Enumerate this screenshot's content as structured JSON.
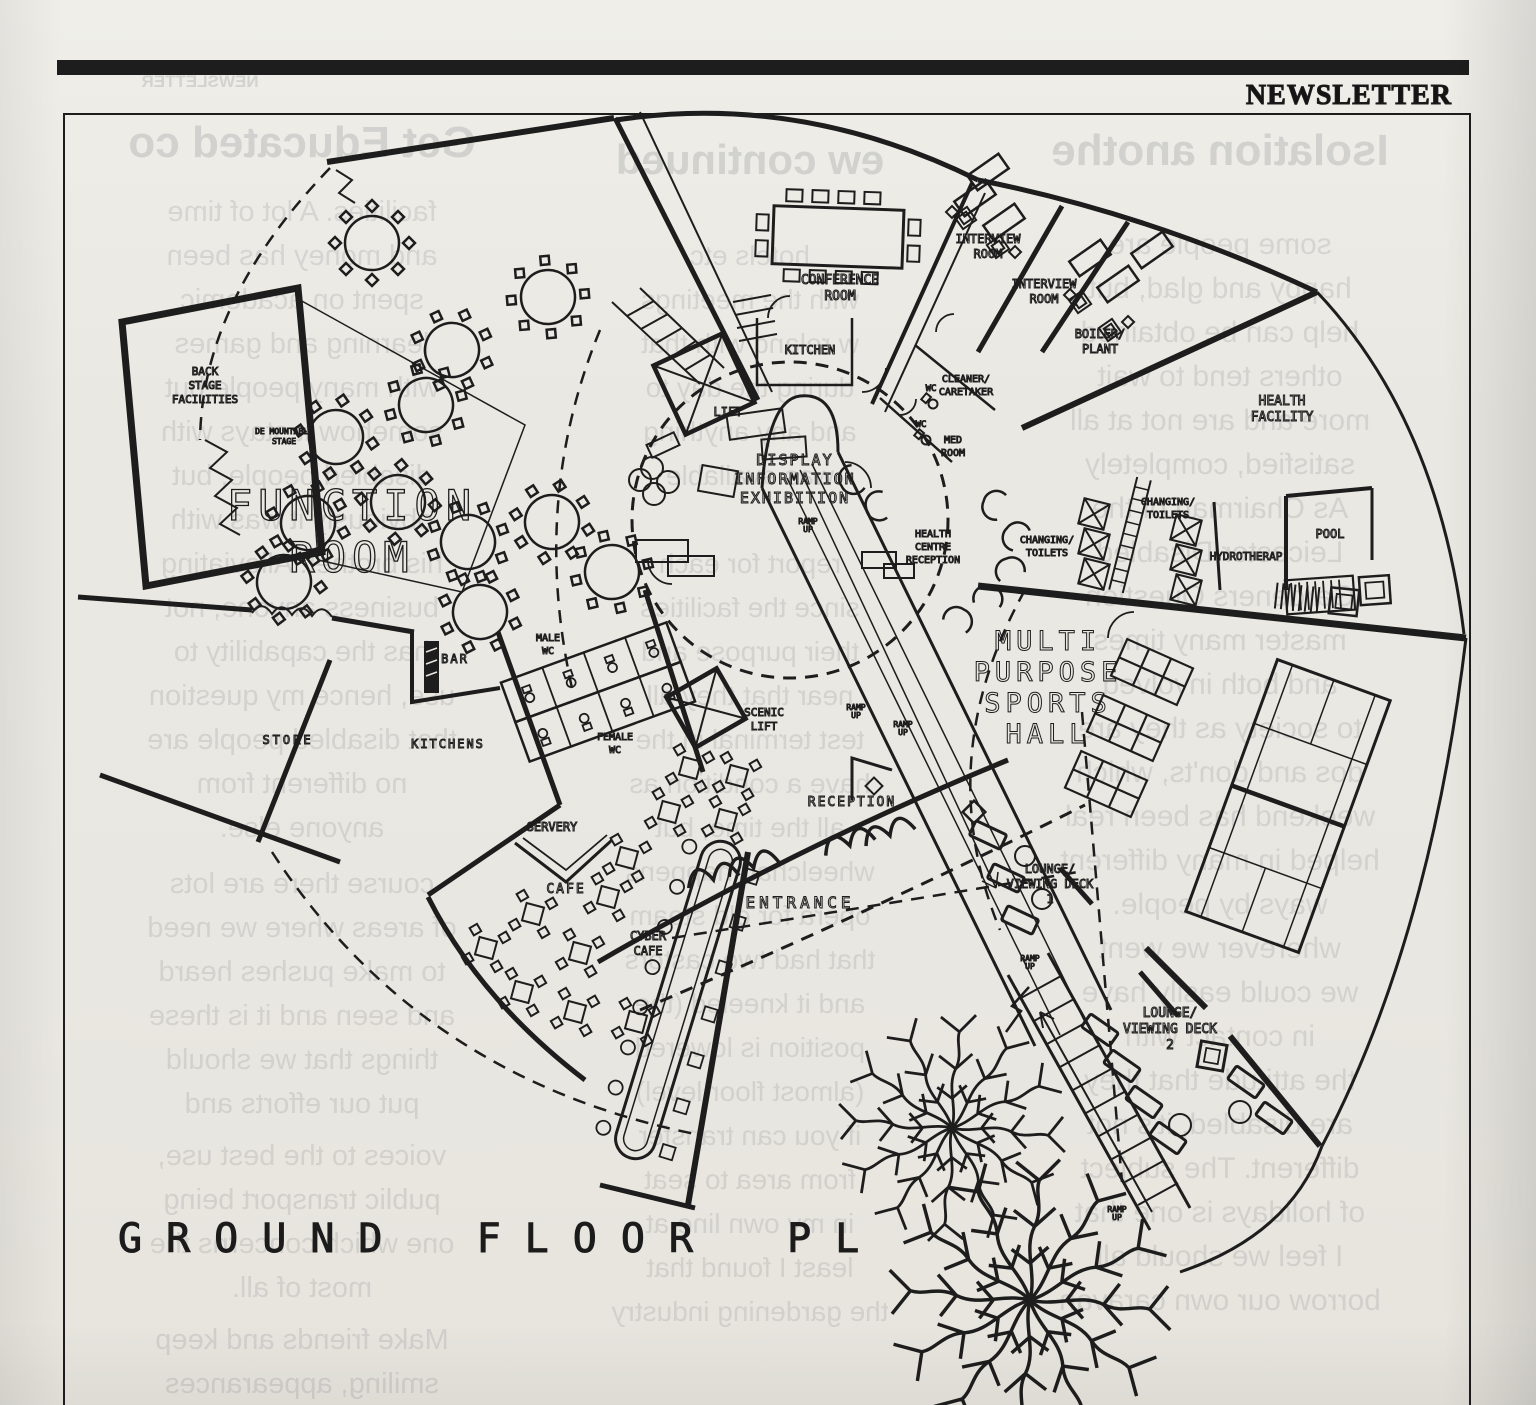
{
  "masthead": {
    "title": "NEWSLETTER"
  },
  "plan_title": "GROUND FLOOR PL",
  "plan": {
    "labels": [
      {
        "name": "conference-room-label",
        "x": 840,
        "y": 284,
        "size": 13,
        "lines": [
          "CONFERENCE",
          "ROOM"
        ]
      },
      {
        "name": "interview-room-1-label",
        "x": 988,
        "y": 243,
        "size": 12,
        "lines": [
          "INTERVIEW",
          "ROOM"
        ]
      },
      {
        "name": "interview-room-2-label",
        "x": 1044,
        "y": 288,
        "size": 12,
        "lines": [
          "INTERVIEW",
          "ROOM"
        ]
      },
      {
        "name": "boiler-plant-label",
        "x": 1100,
        "y": 338,
        "size": 12,
        "lines": [
          "BOILER/",
          "PLANT"
        ]
      },
      {
        "name": "kitchen-top-label",
        "x": 810,
        "y": 354,
        "size": 12,
        "lines": [
          "KITCHEN"
        ]
      },
      {
        "name": "lift-label",
        "x": 728,
        "y": 416,
        "size": 12,
        "lines": [
          "LIFT"
        ]
      },
      {
        "name": "cleaner-caretaker-label",
        "x": 966,
        "y": 382,
        "size": 10,
        "lines": [
          "CLEANER/",
          "CARETAKER"
        ]
      },
      {
        "name": "wc-1-label",
        "x": 931,
        "y": 391,
        "size": 9,
        "lines": [
          "WC"
        ]
      },
      {
        "name": "wc-2-label",
        "x": 921,
        "y": 427,
        "size": 9,
        "lines": [
          "WC"
        ]
      },
      {
        "name": "med-room-label",
        "x": 953,
        "y": 443,
        "size": 10,
        "lines": [
          "MED",
          "ROOM"
        ]
      },
      {
        "name": "health-facility-label",
        "x": 1282,
        "y": 405,
        "size": 13,
        "lines": [
          "HEALTH",
          "FACILITY"
        ]
      },
      {
        "name": "display-information-exhibition-label",
        "x": 795,
        "y": 465,
        "size": 15,
        "ls": 2,
        "lines": [
          "DISPLAY",
          "INFORMATION",
          "EXHIBITION"
        ]
      },
      {
        "name": "changing-toilets-1-label",
        "x": 1168,
        "y": 505,
        "size": 10,
        "lines": [
          "CHANGING/",
          "TOILETS"
        ]
      },
      {
        "name": "changing-toilets-2-label",
        "x": 1047,
        "y": 543,
        "size": 10,
        "lines": [
          "CHANGING/",
          "TOILETS"
        ]
      },
      {
        "name": "health-centre-reception-label",
        "x": 933,
        "y": 537,
        "size": 10,
        "lines": [
          "HEALTH",
          "CENTRE",
          "RECEPTION"
        ]
      },
      {
        "name": "pool-label",
        "x": 1330,
        "y": 538,
        "size": 12,
        "lines": [
          "POOL"
        ]
      },
      {
        "name": "hydrotherapy-label",
        "x": 1246,
        "y": 560,
        "size": 11,
        "lines": [
          "HYDROTHERAP"
        ]
      },
      {
        "name": "back-stage-facilities-label",
        "x": 205,
        "y": 375,
        "size": 11,
        "lines": [
          "BACK",
          "STAGE",
          "FACILITIES"
        ]
      },
      {
        "name": "demountable-stage-label",
        "x": 284,
        "y": 434,
        "size": 8,
        "lines": [
          "DE MOUNTABLE",
          "STAGE"
        ]
      },
      {
        "name": "function-room-label",
        "x": 352,
        "y": 520,
        "size": 42,
        "ls": 6,
        "cls": "outline",
        "lh": 52,
        "lines": [
          "FUNCTION",
          "ROOM"
        ]
      },
      {
        "name": "multi-purpose-sports-hall-label",
        "x": 1048,
        "y": 650,
        "size": 27,
        "ls": 5,
        "lh": 31,
        "lines": [
          "MULTI",
          "PURPOSE",
          "SPORTS",
          "HALL"
        ]
      },
      {
        "name": "bar-label",
        "x": 455,
        "y": 663,
        "size": 12,
        "ls": 2,
        "lines": [
          "BAR"
        ]
      },
      {
        "name": "male-wc-label",
        "x": 548,
        "y": 641,
        "size": 10,
        "lines": [
          "MALE",
          "WC"
        ]
      },
      {
        "name": "female-wc-label",
        "x": 615,
        "y": 740,
        "size": 10,
        "lines": [
          "FEMALE",
          "WC"
        ]
      },
      {
        "name": "store-label",
        "x": 288,
        "y": 744,
        "size": 12,
        "ls": 3,
        "lines": [
          "STORE"
        ]
      },
      {
        "name": "kitchens-label",
        "x": 448,
        "y": 748,
        "size": 12,
        "ls": 2,
        "lines": [
          "KITCHENS"
        ]
      },
      {
        "name": "servery-label",
        "x": 552,
        "y": 831,
        "size": 12,
        "lines": [
          "SERVERY"
        ]
      },
      {
        "name": "scenic-lift-label",
        "x": 764,
        "y": 716,
        "size": 11,
        "lines": [
          "SCENIC",
          "LIFT"
        ]
      },
      {
        "name": "reception-label",
        "x": 852,
        "y": 806,
        "size": 13,
        "ls": 2,
        "lines": [
          "RECEPTION"
        ]
      },
      {
        "name": "cafe-label",
        "x": 566,
        "y": 893,
        "size": 13,
        "ls": 2,
        "lines": [
          "CAFE"
        ]
      },
      {
        "name": "cyber-cafe-label",
        "x": 648,
        "y": 940,
        "size": 12,
        "lines": [
          "CYBER",
          "CAFE"
        ]
      },
      {
        "name": "entrance-label",
        "x": 800,
        "y": 908,
        "size": 16,
        "ls": 4,
        "lines": [
          "ENTRANCE"
        ]
      },
      {
        "name": "lounge-viewing-deck-1-label",
        "x": 1050,
        "y": 873,
        "size": 12,
        "lines": [
          "LOUNGE/",
          "VIEWING DECK",
          "1"
        ]
      },
      {
        "name": "lounge-viewing-deck-2-label",
        "x": 1170,
        "y": 1017,
        "size": 13,
        "lines": [
          "LOUNGE/",
          "VIEWING DECK",
          "2"
        ]
      },
      {
        "name": "ramp-up-1-label",
        "x": 808,
        "y": 524,
        "size": 8,
        "lh": 8,
        "lines": [
          "RAMP",
          "UP"
        ]
      },
      {
        "name": "ramp-up-2-label",
        "x": 856,
        "y": 710,
        "size": 8,
        "lh": 8,
        "lines": [
          "RAMP",
          "UP"
        ]
      },
      {
        "name": "ramp-up-3-label",
        "x": 903,
        "y": 727,
        "size": 8,
        "lh": 8,
        "lines": [
          "RAMP",
          "UP"
        ]
      },
      {
        "name": "ramp-up-4-label",
        "x": 1030,
        "y": 961,
        "size": 8,
        "lh": 8,
        "lines": [
          "RAMP",
          "UP"
        ]
      },
      {
        "name": "ramp-up-5-label",
        "x": 1117,
        "y": 1212,
        "size": 8,
        "lh": 8,
        "lines": [
          "RAMP",
          "UP"
        ]
      }
    ]
  },
  "ghost": {
    "columns": [
      {
        "name": "ghost-masthead",
        "left": 70,
        "width": 260,
        "lines": [
          {
            "y": 72,
            "s": 17,
            "b": 1,
            "t": "NEWSLETTER"
          }
        ]
      },
      {
        "name": "ghost-column-left",
        "left": 84,
        "width": 436,
        "lines": [
          {
            "y": 118,
            "s": 44,
            "b": 1,
            "t": "Get Educated co"
          },
          {
            "y": 196,
            "s": 29,
            "t": "facilities.  A lot of time"
          },
          {
            "y": 240,
            "s": 29,
            "t": "and money has been"
          },
          {
            "y": 284,
            "s": 29,
            "t": "spent on academic"
          },
          {
            "y": 328,
            "s": 29,
            "t": "learning and games"
          },
          {
            "y": 372,
            "s": 29,
            "t": "with many people but"
          },
          {
            "y": 416,
            "s": 29,
            "t": "somehow it stays with"
          },
          {
            "y": 460,
            "s": 29,
            "t": "disabled people, but"
          },
          {
            "y": 504,
            "s": 29,
            "t": "obviously it was with"
          },
          {
            "y": 548,
            "s": 29,
            "t": "his brother. Alleviating"
          },
          {
            "y": 592,
            "s": 29,
            "t": "business anyone, not"
          },
          {
            "y": 636,
            "s": 29,
            "t": "has the capability to"
          },
          {
            "y": 680,
            "s": 29,
            "t": "use, hence my question"
          },
          {
            "y": 724,
            "s": 29,
            "t": "that disabled people are"
          },
          {
            "y": 768,
            "s": 29,
            "t": "no different from"
          },
          {
            "y": 812,
            "s": 29,
            "t": "anyone else."
          },
          {
            "y": 868,
            "s": 29,
            "t": "course there are lots"
          },
          {
            "y": 912,
            "s": 29,
            "t": "of areas where we need"
          },
          {
            "y": 956,
            "s": 29,
            "t": "to make pushes heard"
          },
          {
            "y": 1000,
            "s": 29,
            "t": "and seen and it is these"
          },
          {
            "y": 1044,
            "s": 29,
            "t": "things that we should"
          },
          {
            "y": 1088,
            "s": 29,
            "t": "put our efforts and"
          },
          {
            "y": 1140,
            "s": 29,
            "t": "voices to the best use,"
          },
          {
            "y": 1184,
            "s": 29,
            "t": "public transport being"
          },
          {
            "y": 1228,
            "s": 29,
            "t": "one which concerns the"
          },
          {
            "y": 1272,
            "s": 29,
            "t": "most of all."
          },
          {
            "y": 1324,
            "s": 29,
            "t": "Make friends and keep"
          },
          {
            "y": 1368,
            "s": 29,
            "t": "smiling, appearances"
          }
        ]
      },
      {
        "name": "ghost-column-middle",
        "left": 560,
        "width": 380,
        "lines": [
          {
            "y": 136,
            "s": 42,
            "b": 1,
            "t": "ew continued"
          },
          {
            "y": 240,
            "s": 28,
            "t": "hotels etc"
          },
          {
            "y": 284,
            "s": 28,
            "t": "with the meetings"
          },
          {
            "y": 328,
            "s": 28,
            "t": "w reland with that"
          },
          {
            "y": 372,
            "s": 28,
            "t": "during the day to"
          },
          {
            "y": 416,
            "s": 28,
            "t": "and any anything"
          },
          {
            "y": 460,
            "s": 28,
            "t": "was available"
          },
          {
            "y": 548,
            "s": 28,
            "t": "report for each"
          },
          {
            "y": 592,
            "s": 28,
            "t": "since the facilities"
          },
          {
            "y": 636,
            "s": 28,
            "t": "their purpose and"
          },
          {
            "y": 680,
            "s": 28,
            "t": "near that they all"
          },
          {
            "y": 724,
            "s": 28,
            "t": "test terminal in the"
          },
          {
            "y": 768,
            "s": 28,
            "t": "have a condition as"
          },
          {
            "y": 812,
            "s": 28,
            "t": "all the time, but"
          },
          {
            "y": 856,
            "s": 28,
            "t": "wheelchair happens"
          },
          {
            "y": 900,
            "s": 28,
            "t": "opera for old steam"
          },
          {
            "y": 944,
            "s": 28,
            "t": "that had two castors"
          },
          {
            "y": 988,
            "s": 28,
            "t": "and it kneeled (the"
          },
          {
            "y": 1032,
            "s": 28,
            "t": "position is lowered"
          },
          {
            "y": 1076,
            "s": 28,
            "t": "(almost floor level)"
          },
          {
            "y": 1120,
            "s": 28,
            "t": "if you can transfer"
          },
          {
            "y": 1164,
            "s": 28,
            "t": "from area to seat"
          },
          {
            "y": 1208,
            "s": 28,
            "t": "in my own line at"
          },
          {
            "y": 1252,
            "s": 28,
            "t": "least I found that"
          },
          {
            "y": 1296,
            "s": 28,
            "t": "the gardening industry"
          }
        ]
      },
      {
        "name": "ghost-column-right",
        "left": 985,
        "width": 470,
        "lines": [
          {
            "y": 126,
            "s": 44,
            "b": 1,
            "t": "Isolation anothe"
          },
          {
            "y": 228,
            "s": 30,
            "t": "some people are"
          },
          {
            "y": 272,
            "s": 30,
            "t": "happy and glad, but"
          },
          {
            "y": 316,
            "s": 30,
            "t": "help can be obtained"
          },
          {
            "y": 360,
            "s": 30,
            "t": "others tend to wait"
          },
          {
            "y": 404,
            "s": 30,
            "t": "more and are not at all"
          },
          {
            "y": 448,
            "s": 30,
            "t": "satisfied, completely"
          },
          {
            "y": 492,
            "s": 30,
            "t": "As Chairman of the"
          },
          {
            "y": 536,
            "s": 30,
            "t": "Leicester Disabled"
          },
          {
            "y": 580,
            "s": 30,
            "t": "Gardeners Question"
          },
          {
            "y": 624,
            "s": 30,
            "t": "master many times"
          },
          {
            "y": 668,
            "s": 30,
            "t": "and both involved"
          },
          {
            "y": 712,
            "s": 30,
            "t": "to society as they are"
          },
          {
            "y": 756,
            "s": 30,
            "t": "dos and don'ts, which"
          },
          {
            "y": 800,
            "s": 30,
            "t": "weekend has been real"
          },
          {
            "y": 844,
            "s": 30,
            "t": "helped in many different"
          },
          {
            "y": 888,
            "s": 30,
            "t": "ways by people."
          },
          {
            "y": 932,
            "s": 30,
            "t": "wherever we went"
          },
          {
            "y": 976,
            "s": 30,
            "t": "we could easily have"
          },
          {
            "y": 1020,
            "s": 30,
            "t": "in contact with"
          },
          {
            "y": 1064,
            "s": 30,
            "t": "the attitude that they"
          },
          {
            "y": 1108,
            "s": 30,
            "t": "are disabled, it's not"
          },
          {
            "y": 1152,
            "s": 30,
            "t": "different.  The subject"
          },
          {
            "y": 1196,
            "s": 30,
            "t": "of holidays is one that"
          },
          {
            "y": 1240,
            "s": 30,
            "t": "I feel we should all"
          },
          {
            "y": 1284,
            "s": 30,
            "t": "borrow our own caravan"
          }
        ]
      }
    ]
  }
}
